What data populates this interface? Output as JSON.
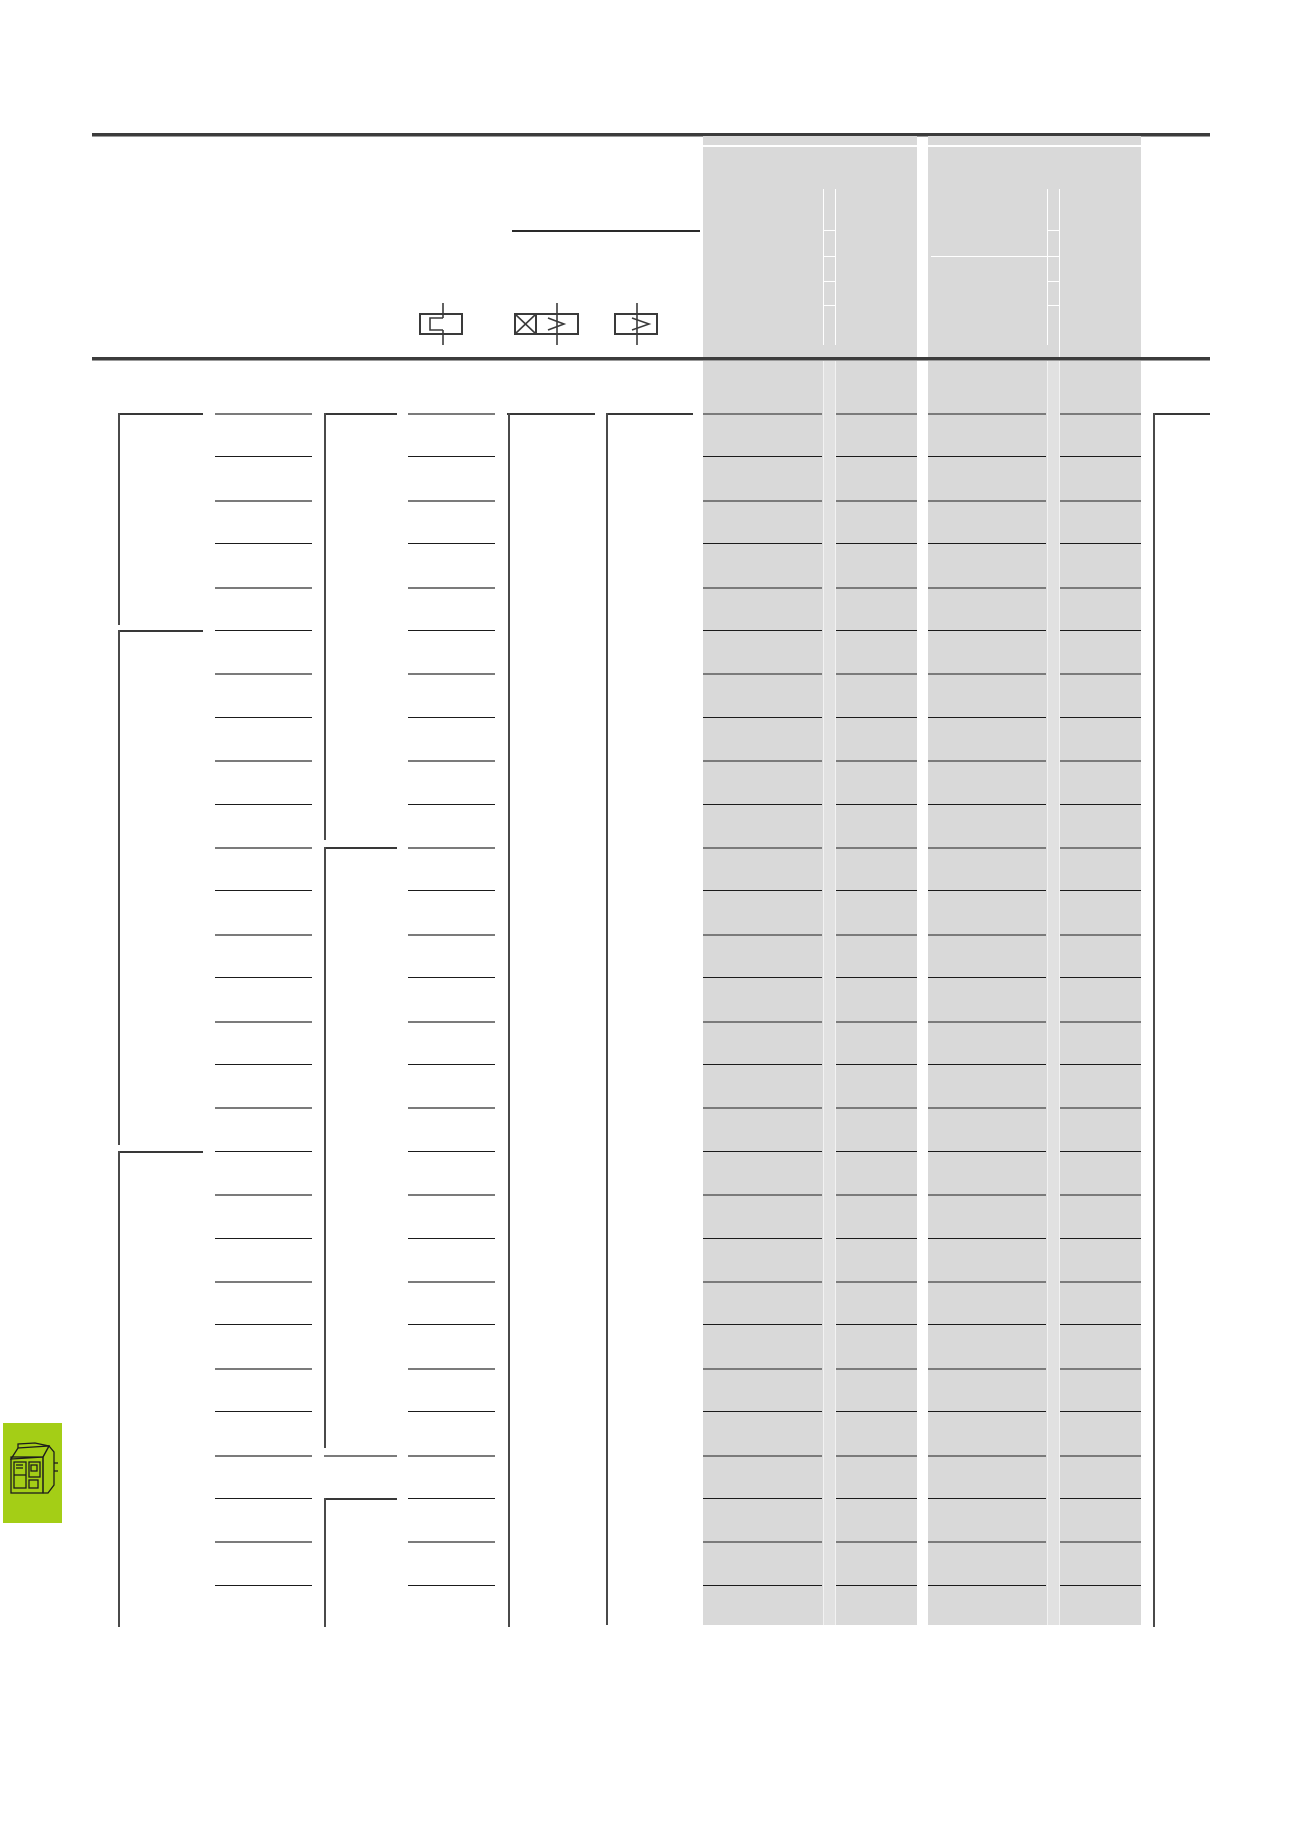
{
  "document": {
    "kind": "catalog-table-page",
    "visible_text": "",
    "note_colors": {
      "page_background": "#ffffff",
      "thick_rule": "#3c3c3c",
      "gray_band": "#d9d9d9",
      "band_divider_strip": "#e1e1e1",
      "row_line_gray": "#7b7b7b",
      "row_line_dark": "#1b1b1b",
      "column_rule": "#4a4a4a",
      "symbol_stroke": "#3a3a3a",
      "accent_green": "#a4ce16"
    }
  },
  "header": {
    "thick_rule_top_y": 133,
    "thick_rule_bottom_y": 357,
    "underline_segment": {
      "x": 512,
      "y": 230,
      "width": 188
    },
    "gray_bands": [
      {
        "x": 703,
        "width": 214
      },
      {
        "x": 928,
        "width": 213
      }
    ],
    "symbols": [
      {
        "name": "switch-contact-symbol"
      },
      {
        "name": "breaker-release-overcurrent-symbol"
      },
      {
        "name": "overcurrent-release-symbol"
      }
    ]
  },
  "table": {
    "row_count": 28,
    "first_row_y": 413,
    "row_pitch": 43.4,
    "row_segments": [
      [
        215,
        97
      ],
      [
        408,
        87
      ],
      [
        703,
        119
      ],
      [
        836,
        81
      ],
      [
        928,
        118
      ],
      [
        1060,
        81
      ]
    ],
    "corner_columns": [
      {
        "x": 118,
        "w": 85,
        "rows": [
          0,
          5,
          17
        ]
      },
      {
        "x": 324,
        "w": 73,
        "rows": [
          0,
          10,
          25
        ]
      },
      {
        "x": 507,
        "w": 88,
        "rows": [
          0
        ]
      },
      {
        "x": 606,
        "w": 87,
        "rows": [
          0
        ]
      },
      {
        "x": 1153,
        "w": 57,
        "rows": [
          0
        ]
      }
    ],
    "col3_dash": {
      "x": 324,
      "w": 73,
      "rows": [
        24
      ]
    },
    "verticals": [
      {
        "x": 118,
        "segments": [
          [
            413,
            625
          ],
          [
            630,
            1145
          ],
          [
            1151,
            1627
          ]
        ]
      },
      {
        "x": 324,
        "segments": [
          [
            413,
            840
          ],
          [
            847,
            1448
          ],
          [
            1498,
            1627
          ]
        ]
      },
      {
        "x": 508,
        "segments": [
          [
            413,
            1627
          ]
        ]
      },
      {
        "x": 606,
        "segments": [
          [
            413,
            1625
          ]
        ]
      },
      {
        "x": 1153,
        "segments": [
          [
            413,
            1627
          ]
        ]
      }
    ]
  },
  "footer_icon": {
    "name": "circuit-breaker-product-icon",
    "background": "#a4ce16"
  }
}
